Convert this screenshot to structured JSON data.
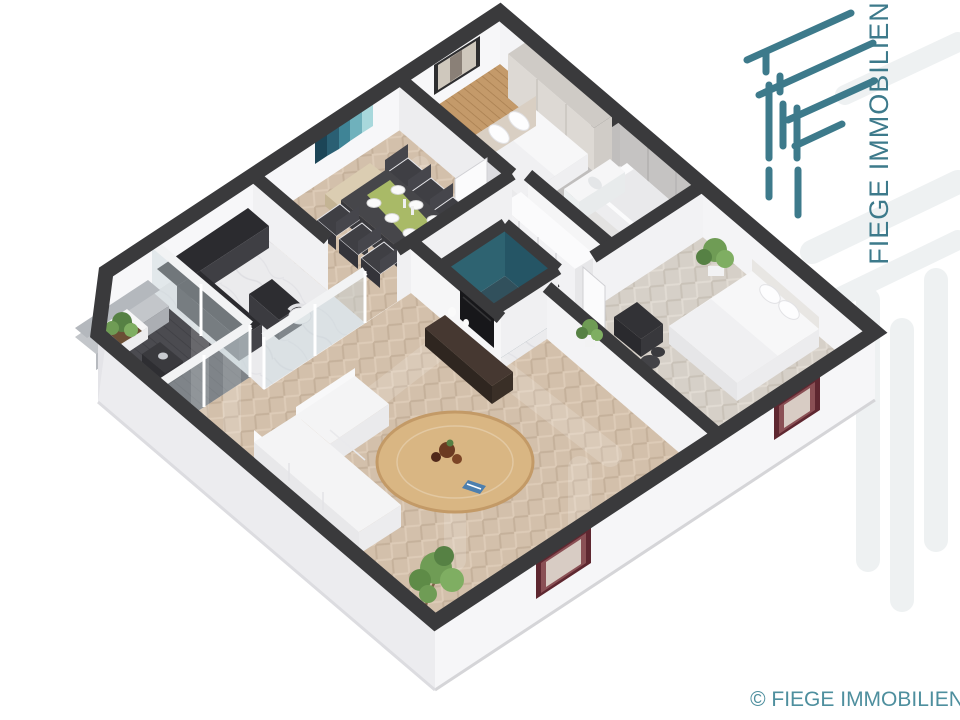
{
  "brand": {
    "name": "FIEGE IMMOBILIEN",
    "copyright": "© FIEGE IMMOBILIEN"
  },
  "colors": {
    "brandTeal": "#3d7a8b",
    "copyrightTeal": "#4e8f9e",
    "wallTop": "#3a3a3c",
    "wood": "#c49a6a",
    "tealWall": "#2e6371",
    "tealWallDark": "#255565",
    "tealFloor": "#31505c",
    "darkFloor": "#4b4b50",
    "marbleFloor": "#ebebed",
    "maroonWindow": "#5e2730",
    "plantGreen": "#6f9c55",
    "counterDark": "#2b2b2f",
    "walnut": "#463831",
    "rugWood": "#d9b683",
    "runnerGreen": "#a9ba67"
  },
  "scene": {
    "type": "3d-isometric-floorplan",
    "rooms": [
      "living-room",
      "dining-room",
      "kitchen",
      "balcony-loggia",
      "bedroom-1",
      "bedroom-2",
      "bathroom",
      "hallway",
      "storage-teal-room"
    ],
    "furniture": [
      "double-bed",
      "double-bed-2",
      "wardrobe",
      "hall-wardrobe",
      "bathtub",
      "vanity-sink",
      "dining-table",
      "dining-chairs",
      "bench",
      "kitchen-counter",
      "kitchen-island",
      "white-sofa",
      "gray-corner-sofa",
      "round-rug",
      "tv",
      "tv-lowboard",
      "plants",
      "planter-box",
      "desk",
      "desk-chair",
      "teal-stool",
      "wall-art-teal",
      "picture-frame"
    ]
  }
}
